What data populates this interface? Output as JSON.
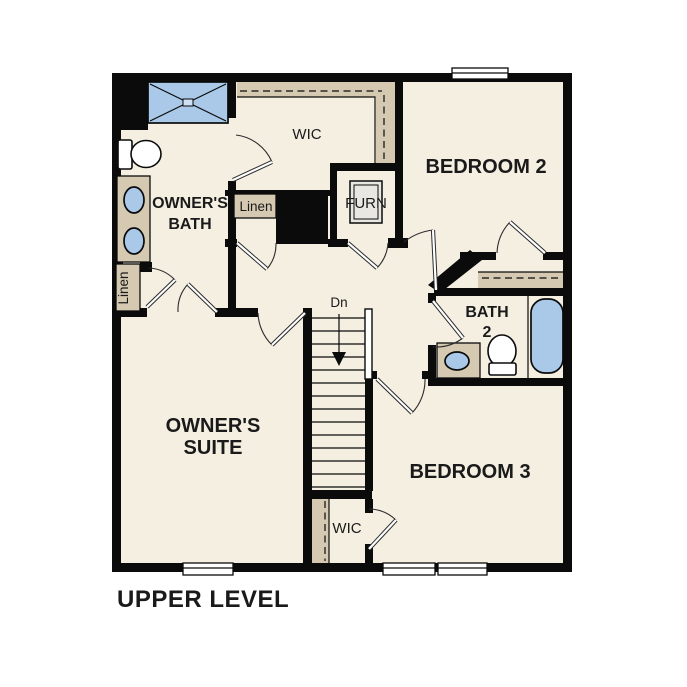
{
  "colors": {
    "background": "#ffffff",
    "wall": "#0b0b0b",
    "floor": "#f5efe2",
    "shelf": "#d5c9b1",
    "fixture-blue": "#aac8e8",
    "fixture-white": "#ffffff",
    "furnace-gray": "#e9e7e2",
    "text": "#1a1a1a"
  },
  "plan": {
    "title": "UPPER LEVEL"
  },
  "rooms": {
    "owners_suite": {
      "line1": "OWNER'S",
      "line2": "SUITE"
    },
    "owners_bath": {
      "line1": "OWNER'S",
      "line2": "BATH"
    },
    "bedroom2": {
      "label": "BEDROOM 2"
    },
    "bedroom3": {
      "label": "BEDROOM 3"
    },
    "bath2": {
      "line1": "BATH",
      "line2": "2"
    },
    "wic_upper": {
      "label": "WIC"
    },
    "wic_lower": {
      "label": "WIC"
    },
    "linen_upper": {
      "label": "Linen"
    },
    "linen_left": {
      "label": "Linen"
    },
    "furnace": {
      "label": "FURN"
    },
    "stairs": {
      "direction_label": "Dn"
    }
  }
}
